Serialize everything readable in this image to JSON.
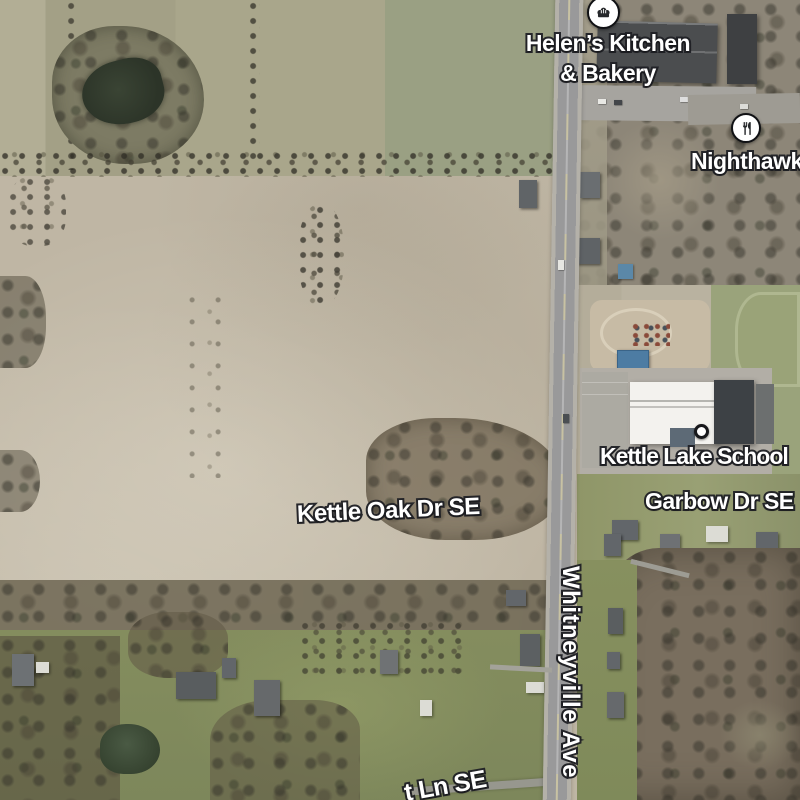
{
  "map": {
    "view_type": "satellite",
    "labels": {
      "helens": {
        "line1": "Helen’s Kitchen",
        "line2": "& Bakery",
        "icon": "bakery"
      },
      "nighthawk": {
        "text": "Nighthawk",
        "icon": "restaurant"
      },
      "school": {
        "text": "Kettle Lake School",
        "marker": "poi-dot"
      },
      "garbow": {
        "text": "Garbow Dr SE"
      },
      "kettle_oak": {
        "text": "Kettle Oak Dr SE"
      },
      "whitneyville": {
        "text": "Whitneyville Ave"
      },
      "partial_lane": {
        "text": "t Ln SE"
      }
    },
    "colors": {
      "field_tan": "#c0b7a4",
      "field_light": "#cdc6b5",
      "olive_field": "#a6a389",
      "woods_gray": "#8b8477",
      "woods_brown": "#75695a",
      "green_lawn": "#858f60",
      "pond_dark": "#39412f",
      "road_gray": "#9b9b99",
      "school_roof_white": "#f4f3ef",
      "roof_dark": "#3e4246",
      "pavilion_blue": "#4d7ca3",
      "label_text": "#ffffff",
      "label_outline": "#202126"
    }
  }
}
